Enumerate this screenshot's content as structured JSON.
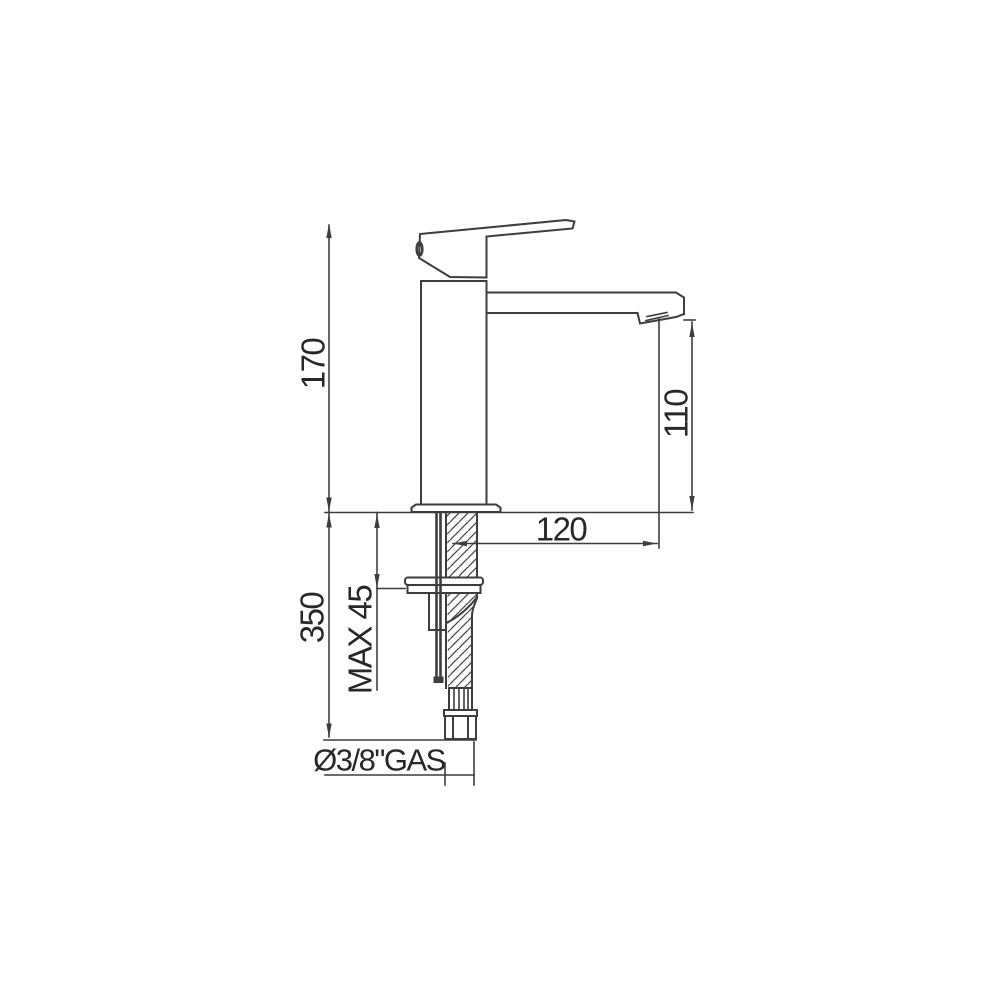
{
  "drawing": {
    "title": "Single-lever basin mixer tap — dimensional side view",
    "background": "#ffffff",
    "line_color": "#3d3d3d",
    "text_color": "#282828",
    "labels": {
      "overall_height": "170",
      "spout_height": "110",
      "spout_reach": "120",
      "below_deck_length": "350",
      "max_mounting_thickness": "MAX 45",
      "supply_connection": "Ø3/8\"GAS"
    }
  }
}
